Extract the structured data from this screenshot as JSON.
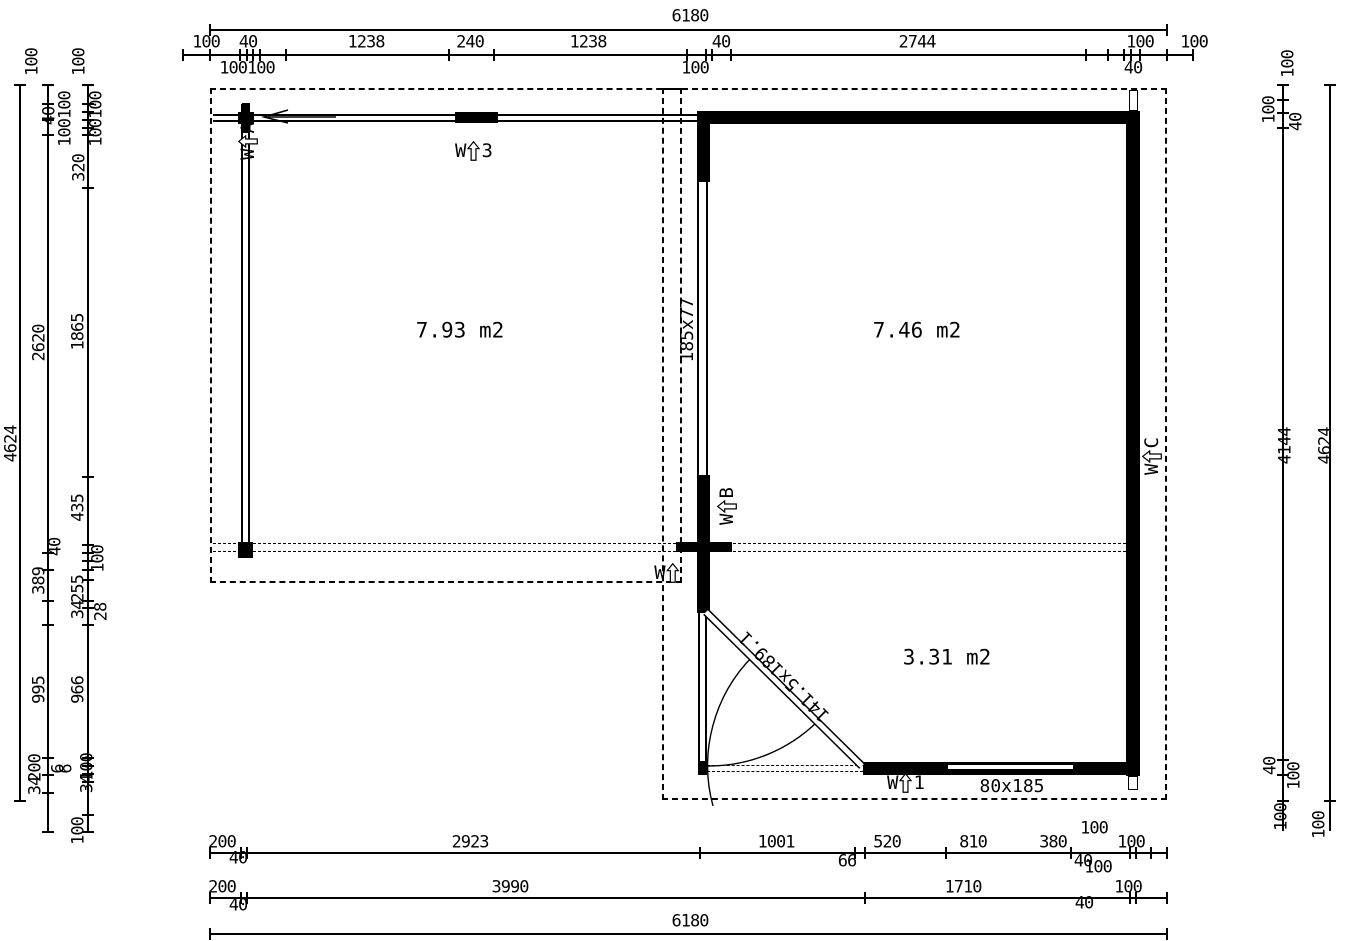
{
  "drawing": {
    "rooms": [
      {
        "area_label": "7.93 m2"
      },
      {
        "area_label": "7.46 m2"
      },
      {
        "area_label": "3.31 m2"
      }
    ],
    "opening_labels": [
      {
        "id": "window-a",
        "prefix": "W",
        "suffix": "A",
        "x": 248,
        "y": 141,
        "rot": -90
      },
      {
        "id": "window-3",
        "prefix": "W",
        "suffix": "3",
        "x": 474,
        "y": 151,
        "rot": 0
      },
      {
        "id": "window-b",
        "prefix": "W",
        "suffix": "B",
        "x": 727,
        "y": 506,
        "rot": -90
      },
      {
        "id": "window-2",
        "prefix": "W",
        "suffix": "",
        "x": 667,
        "y": 573,
        "rot": 0
      },
      {
        "id": "window-c",
        "prefix": "W",
        "suffix": "C",
        "x": 1152,
        "y": 456,
        "rot": -90
      },
      {
        "id": "door-1",
        "prefix": "W",
        "suffix": "1",
        "x": 906,
        "y": 783,
        "rot": 0
      }
    ],
    "size_labels": [
      {
        "t": "185x77",
        "x": 688,
        "y": 330,
        "r": -90
      },
      {
        "t": "141.5x189.1",
        "x": 785,
        "y": 676,
        "r": 225
      },
      {
        "t": "80x185",
        "x": 1012,
        "y": 787,
        "r": 0
      }
    ],
    "dim_labels": [
      {
        "t": "6180",
        "x": 690,
        "y": 17,
        "r": 0
      },
      {
        "t": "100",
        "x": 206,
        "y": 43,
        "r": 0
      },
      {
        "t": "40",
        "x": 248,
        "y": 43,
        "r": 0
      },
      {
        "t": "1238",
        "x": 366,
        "y": 43,
        "r": 0
      },
      {
        "t": "240",
        "x": 470,
        "y": 43,
        "r": 0
      },
      {
        "t": "1238",
        "x": 588,
        "y": 43,
        "r": 0
      },
      {
        "t": "40",
        "x": 721,
        "y": 43,
        "r": 0
      },
      {
        "t": "2744",
        "x": 917,
        "y": 43,
        "r": 0
      },
      {
        "t": "100",
        "x": 1140,
        "y": 43,
        "r": 0
      },
      {
        "t": "100",
        "x": 1194,
        "y": 43,
        "r": 0
      },
      {
        "t": "100100",
        "x": 247,
        "y": 69,
        "r": 0
      },
      {
        "t": "100",
        "x": 695,
        "y": 69,
        "r": 0
      },
      {
        "t": "40",
        "x": 1133,
        "y": 69,
        "r": 0
      },
      {
        "t": "200",
        "x": 222,
        "y": 843,
        "r": 0
      },
      {
        "t": "2923",
        "x": 470,
        "y": 843,
        "r": 0
      },
      {
        "t": "1001",
        "x": 776,
        "y": 843,
        "r": 0
      },
      {
        "t": "520",
        "x": 887,
        "y": 843,
        "r": 0
      },
      {
        "t": "810",
        "x": 973,
        "y": 843,
        "r": 0
      },
      {
        "t": "380",
        "x": 1053,
        "y": 843,
        "r": 0
      },
      {
        "t": "100",
        "x": 1094,
        "y": 829,
        "r": 0
      },
      {
        "t": "100",
        "x": 1131,
        "y": 843,
        "r": 0
      },
      {
        "t": "40",
        "x": 238,
        "y": 859,
        "r": 0
      },
      {
        "t": "66",
        "x": 847,
        "y": 862,
        "r": 0
      },
      {
        "t": "40",
        "x": 1083,
        "y": 862,
        "r": 0
      },
      {
        "t": "100",
        "x": 1098,
        "y": 868,
        "r": 0
      },
      {
        "t": "200",
        "x": 222,
        "y": 888,
        "r": 0
      },
      {
        "t": "3990",
        "x": 510,
        "y": 888,
        "r": 0
      },
      {
        "t": "1710",
        "x": 963,
        "y": 888,
        "r": 0
      },
      {
        "t": "100",
        "x": 1128,
        "y": 888,
        "r": 0
      },
      {
        "t": "40",
        "x": 238,
        "y": 906,
        "r": 0
      },
      {
        "t": "40",
        "x": 1084,
        "y": 904,
        "r": 0
      },
      {
        "t": "6180",
        "x": 690,
        "y": 922,
        "r": 0
      },
      {
        "t": "100",
        "x": 33,
        "y": 62,
        "r": -90
      },
      {
        "t": "100",
        "x": 80,
        "y": 62,
        "r": -90
      },
      {
        "t": "40",
        "x": 50,
        "y": 116,
        "r": -90
      },
      {
        "t": "100100",
        "x": 66,
        "y": 119,
        "r": -90
      },
      {
        "t": "100100",
        "x": 97,
        "y": 119,
        "r": -90
      },
      {
        "t": "320",
        "x": 80,
        "y": 168,
        "r": -90
      },
      {
        "t": "2620",
        "x": 40,
        "y": 343,
        "r": -90
      },
      {
        "t": "1865",
        "x": 79,
        "y": 332,
        "r": -90
      },
      {
        "t": "4624",
        "x": 12,
        "y": 444,
        "r": -90
      },
      {
        "t": "435",
        "x": 79,
        "y": 508,
        "r": -90
      },
      {
        "t": "40",
        "x": 56,
        "y": 547,
        "r": -90
      },
      {
        "t": "100",
        "x": 99,
        "y": 559,
        "r": -90
      },
      {
        "t": "389",
        "x": 40,
        "y": 581,
        "r": -90
      },
      {
        "t": "255",
        "x": 79,
        "y": 589,
        "r": -90
      },
      {
        "t": "34",
        "x": 79,
        "y": 610,
        "r": -90
      },
      {
        "t": "28",
        "x": 102,
        "y": 612,
        "r": -90
      },
      {
        "t": "995",
        "x": 40,
        "y": 690,
        "r": -90
      },
      {
        "t": "966",
        "x": 79,
        "y": 690,
        "r": -90
      },
      {
        "t": "200",
        "x": 36,
        "y": 768,
        "r": -90
      },
      {
        "t": "34",
        "x": 36,
        "y": 786,
        "r": -90
      },
      {
        "t": "6",
        "x": 59,
        "y": 769,
        "r": -90
      },
      {
        "t": "6",
        "x": 67,
        "y": 769,
        "r": -90
      },
      {
        "t": "100",
        "x": 88,
        "y": 767,
        "r": -90
      },
      {
        "t": "34",
        "x": 88,
        "y": 784,
        "r": -90
      },
      {
        "t": "100",
        "x": 79,
        "y": 831,
        "r": -90
      },
      {
        "t": "100",
        "x": 1289,
        "y": 64,
        "r": -90
      },
      {
        "t": "100",
        "x": 1270,
        "y": 110,
        "r": -90
      },
      {
        "t": "40",
        "x": 1297,
        "y": 122,
        "r": -90
      },
      {
        "t": "4144",
        "x": 1286,
        "y": 446,
        "r": -90
      },
      {
        "t": "4624",
        "x": 1326,
        "y": 446,
        "r": -90
      },
      {
        "t": "40",
        "x": 1271,
        "y": 766,
        "r": -90
      },
      {
        "t": "100",
        "x": 1295,
        "y": 776,
        "r": -90
      },
      {
        "t": "100",
        "x": 1282,
        "y": 817,
        "r": -90
      },
      {
        "t": "100",
        "x": 1320,
        "y": 825,
        "r": -90
      }
    ]
  }
}
